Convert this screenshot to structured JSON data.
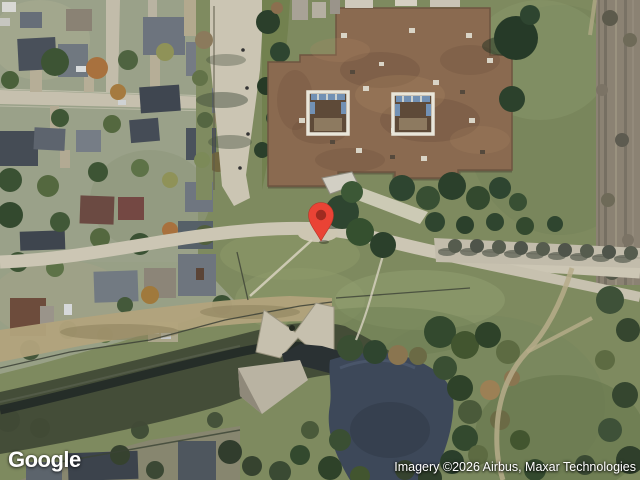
{
  "map": {
    "view_type": "satellite",
    "marker": {
      "icon": "location-pin-icon",
      "color": "#EA4335",
      "dot_color": "#9E2B20"
    }
  },
  "footer": {
    "logo_text": "Google",
    "attribution_text": "Imagery ©2026 Airbus, Maxar Technologies"
  }
}
